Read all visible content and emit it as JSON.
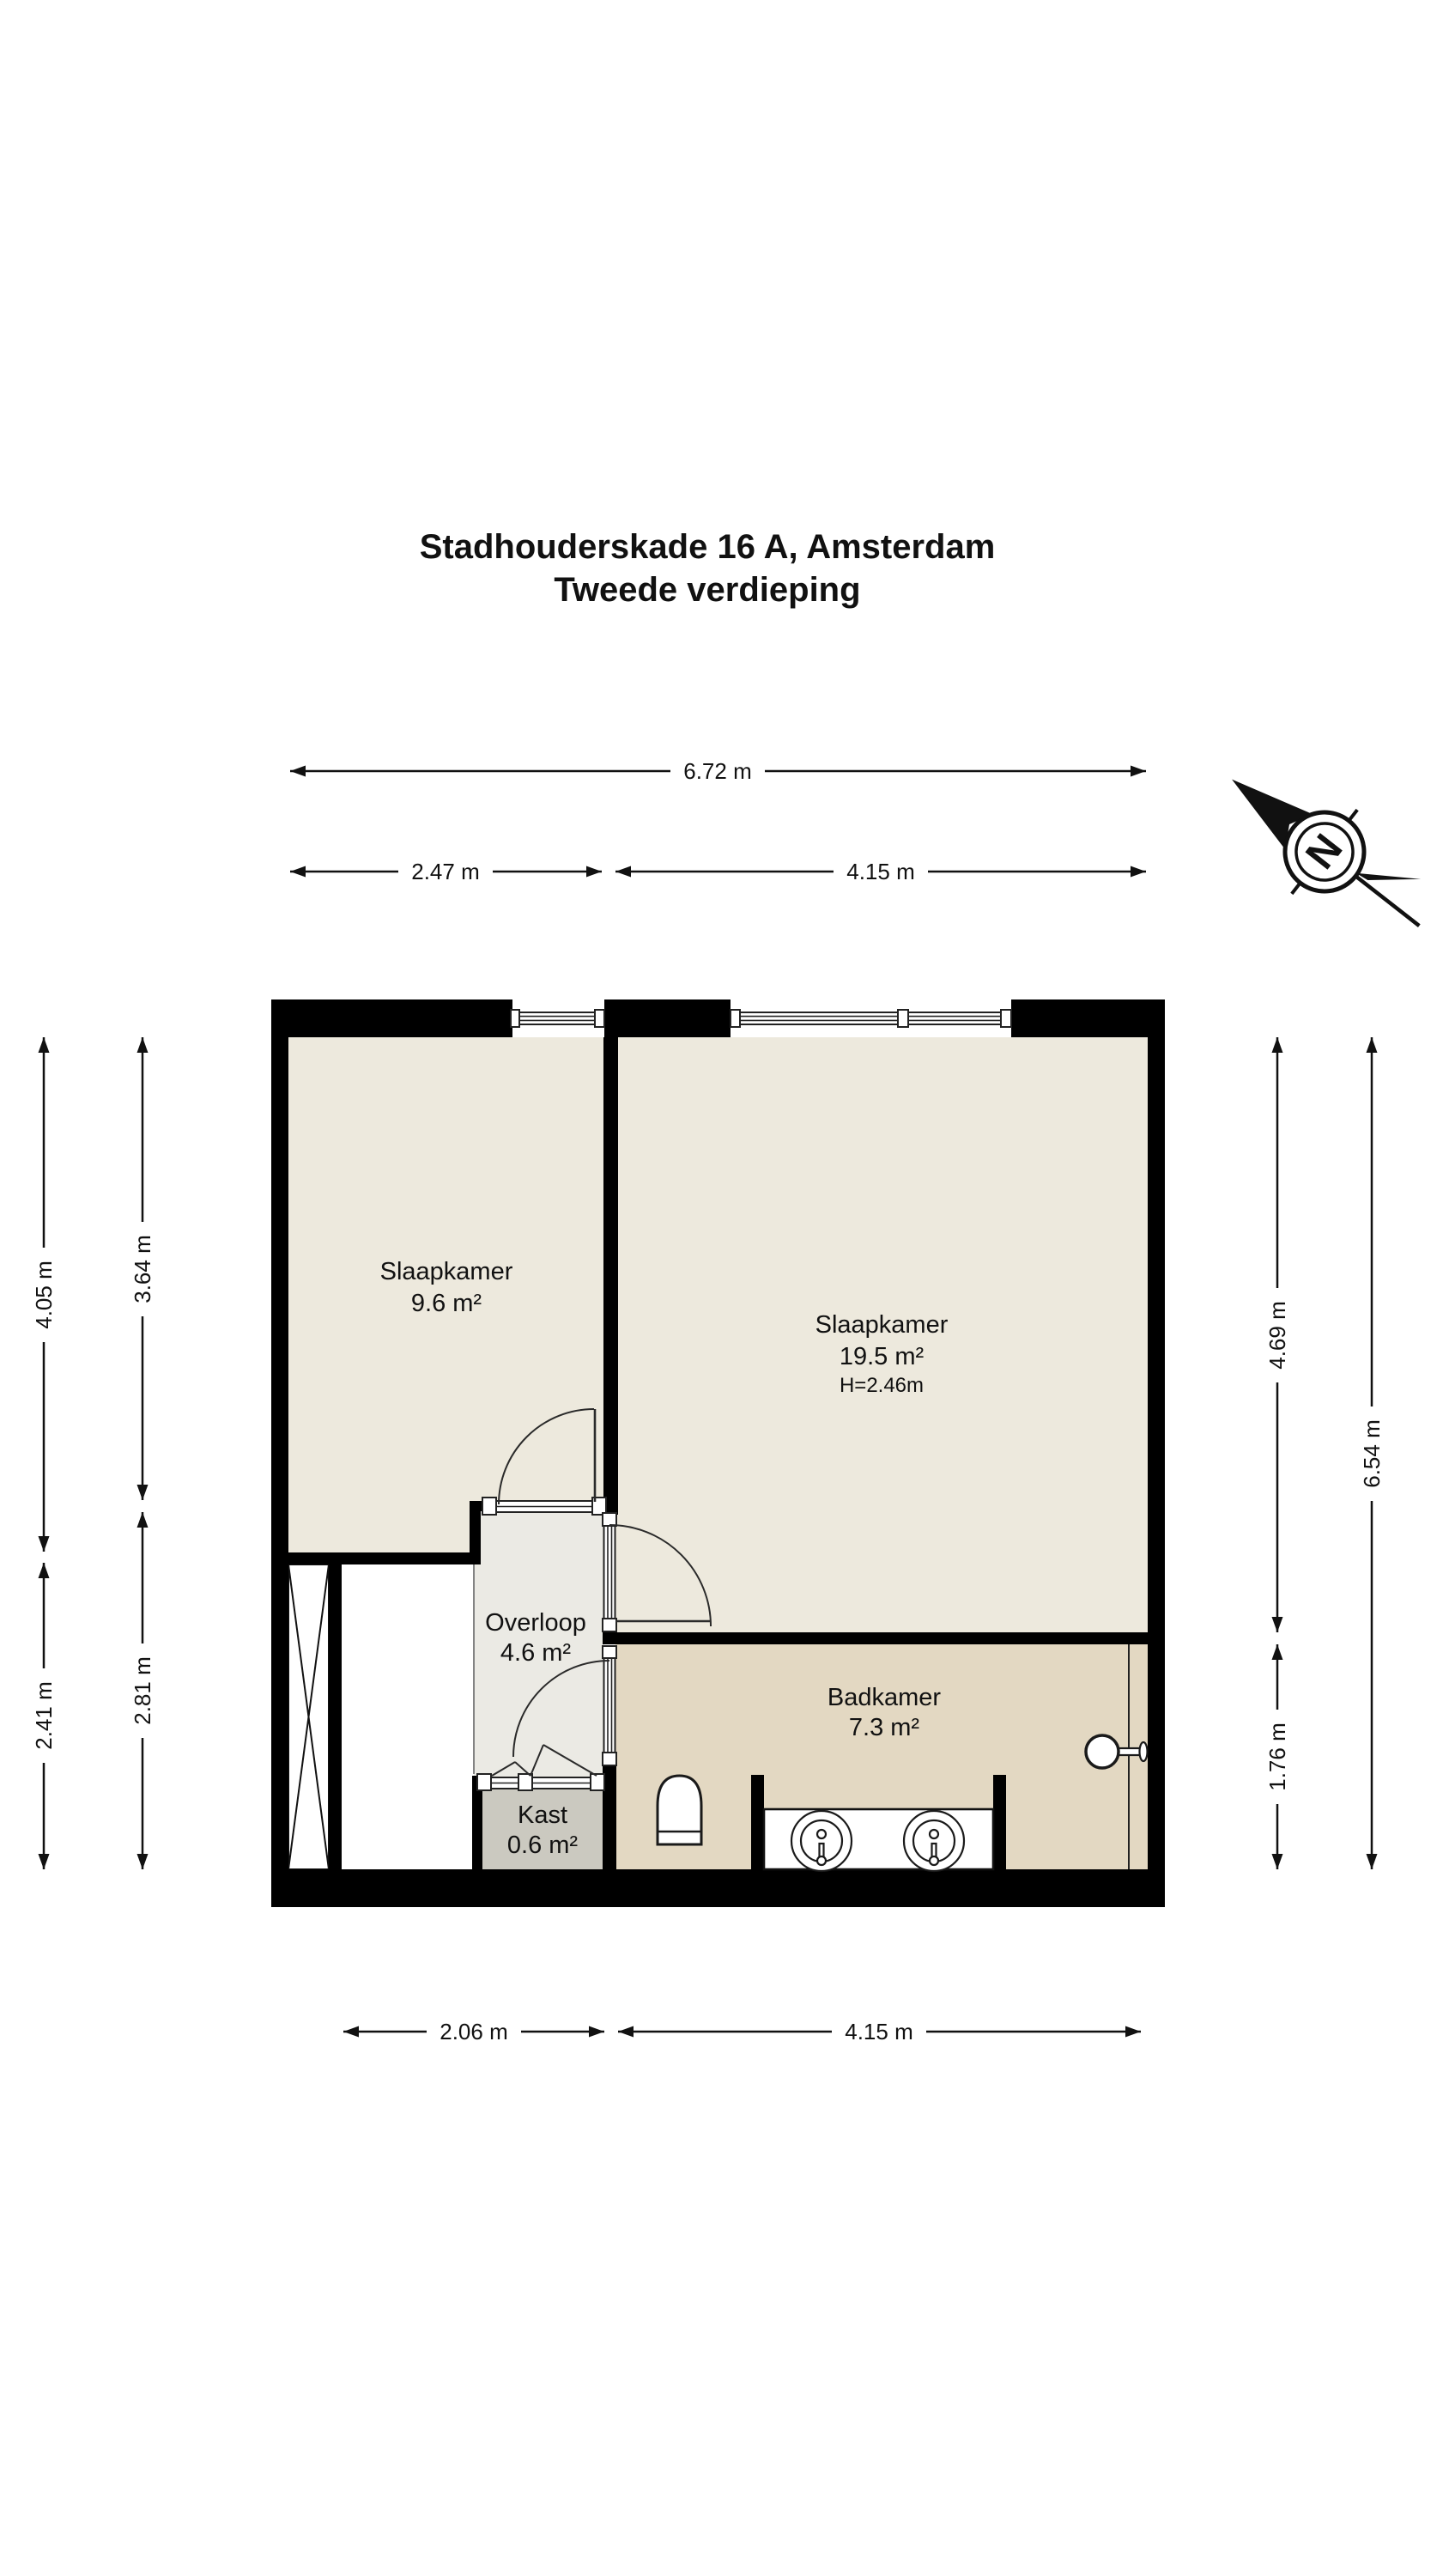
{
  "title": {
    "line1": "Stadhouderskade 16 A, Amsterdam",
    "line2": "Tweede verdieping"
  },
  "compass": {
    "label": "N"
  },
  "dimensions": {
    "top_total": "6.72 m",
    "top_left": "2.47 m",
    "top_right": "4.15 m",
    "bottom_left": "2.06 m",
    "bottom_right": "4.15 m",
    "left_outer_upper": "4.05 m",
    "left_outer_lower": "2.41 m",
    "left_inner_upper": "3.64 m",
    "left_inner_lower": "2.81 m",
    "right_inner_upper": "4.69 m",
    "right_inner_lower": "1.76 m",
    "right_outer": "6.54 m"
  },
  "rooms": {
    "bedroom_small": {
      "name": "Slaapkamer",
      "area": "9.6 m²"
    },
    "bedroom_large": {
      "name": "Slaapkamer",
      "area": "19.5 m²",
      "ceiling_height": "H=2.46m"
    },
    "landing": {
      "name": "Overloop",
      "area": "4.6 m²"
    },
    "bathroom": {
      "name": "Badkamer",
      "area": "7.3 m²"
    },
    "closet": {
      "name": "Kast",
      "area": "0.6 m²"
    }
  },
  "colors": {
    "wall": "#000000",
    "bedroom_floor": "#EDE9DD",
    "bathroom_floor": "#E3D8C2",
    "landing_floor": "#EBEAE4",
    "closet_floor": "#CBC9C0",
    "background": "#FFFFFF"
  }
}
